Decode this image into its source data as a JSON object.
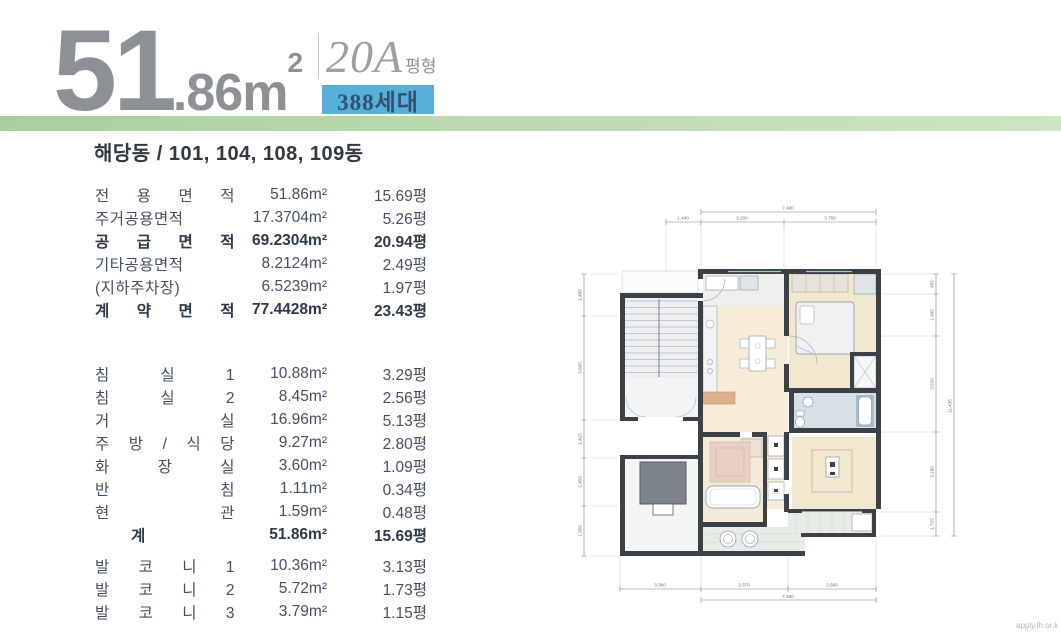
{
  "header": {
    "area_big": "51",
    "area_rest": ".86m",
    "area_sup": "2",
    "type_code": "20A",
    "type_suffix": "평형",
    "households": "388세대"
  },
  "colors": {
    "accent_green": "#b7d6aa",
    "badge_blue": "#57b0da",
    "title_gray": "#8d9193",
    "wall_dark": "#3c4146",
    "floor_cream": "#f7ecd8",
    "floor_beige": "#f2e8d0",
    "bath_blue": "#d5e1e7",
    "table_text": "#45505e"
  },
  "subtitle": "해당동 / 101, 104, 108, 109동",
  "table": {
    "rows": [
      {
        "label": "전 용 면 적",
        "m2": "51.86m²",
        "py": "15.69평"
      },
      {
        "label": "주거공용면적",
        "m2": "17.3704m²",
        "py": "5.26평"
      },
      {
        "label": "공 급 면 적",
        "m2": "69.2304m²",
        "py": "20.94평"
      },
      {
        "label": "기타공용면적",
        "m2": "8.2124m²",
        "py": "2.49평"
      },
      {
        "label": "(지하주차장)",
        "m2": "6.5239m²",
        "py": "1.97평"
      },
      {
        "label": "계 약 면 적",
        "m2": "77.4428m²",
        "py": "23.43평"
      },
      {
        "label": "침 실 1",
        "m2": "10.88m²",
        "py": "3.29평"
      },
      {
        "label": "침 실 2",
        "m2": "8.45m²",
        "py": "2.56평"
      },
      {
        "label": "거 실",
        "m2": "16.96m²",
        "py": "5.13평"
      },
      {
        "label": "주 방 / 식 당",
        "m2": "9.27m²",
        "py": "2.80평"
      },
      {
        "label": "화 장 실",
        "m2": "3.60m²",
        "py": "1.09평"
      },
      {
        "label": "반 침",
        "m2": "1.11m²",
        "py": "0.34평"
      },
      {
        "label": "현 관",
        "m2": "1.59m²",
        "py": "0.48평"
      },
      {
        "label": "계",
        "m2": "51.86m²",
        "py": "15.69평"
      },
      {
        "label": "발 코 니 1",
        "m2": "10.36m²",
        "py": "3.13평"
      },
      {
        "label": "발 코 니 2",
        "m2": "5.72m²",
        "py": "1.73평"
      },
      {
        "label": "발 코 니 3",
        "m2": "3.79m²",
        "py": "1.15평"
      }
    ]
  },
  "floorplan": {
    "dims": {
      "top_total": "7.400",
      "top": [
        "1.440",
        "3.200",
        "3.760"
      ],
      "bottom": [
        "3.360",
        "3.370",
        "3.600"
      ],
      "bottom_total": "7.460",
      "left": [
        "1.495",
        "3.605",
        "1.415",
        "2.450",
        "1.350"
      ],
      "right": [
        "455",
        "1.485",
        "3.520",
        "3.180",
        "1.725"
      ],
      "right_total": "11.435"
    },
    "watermark": "apply.lh.or.k"
  }
}
